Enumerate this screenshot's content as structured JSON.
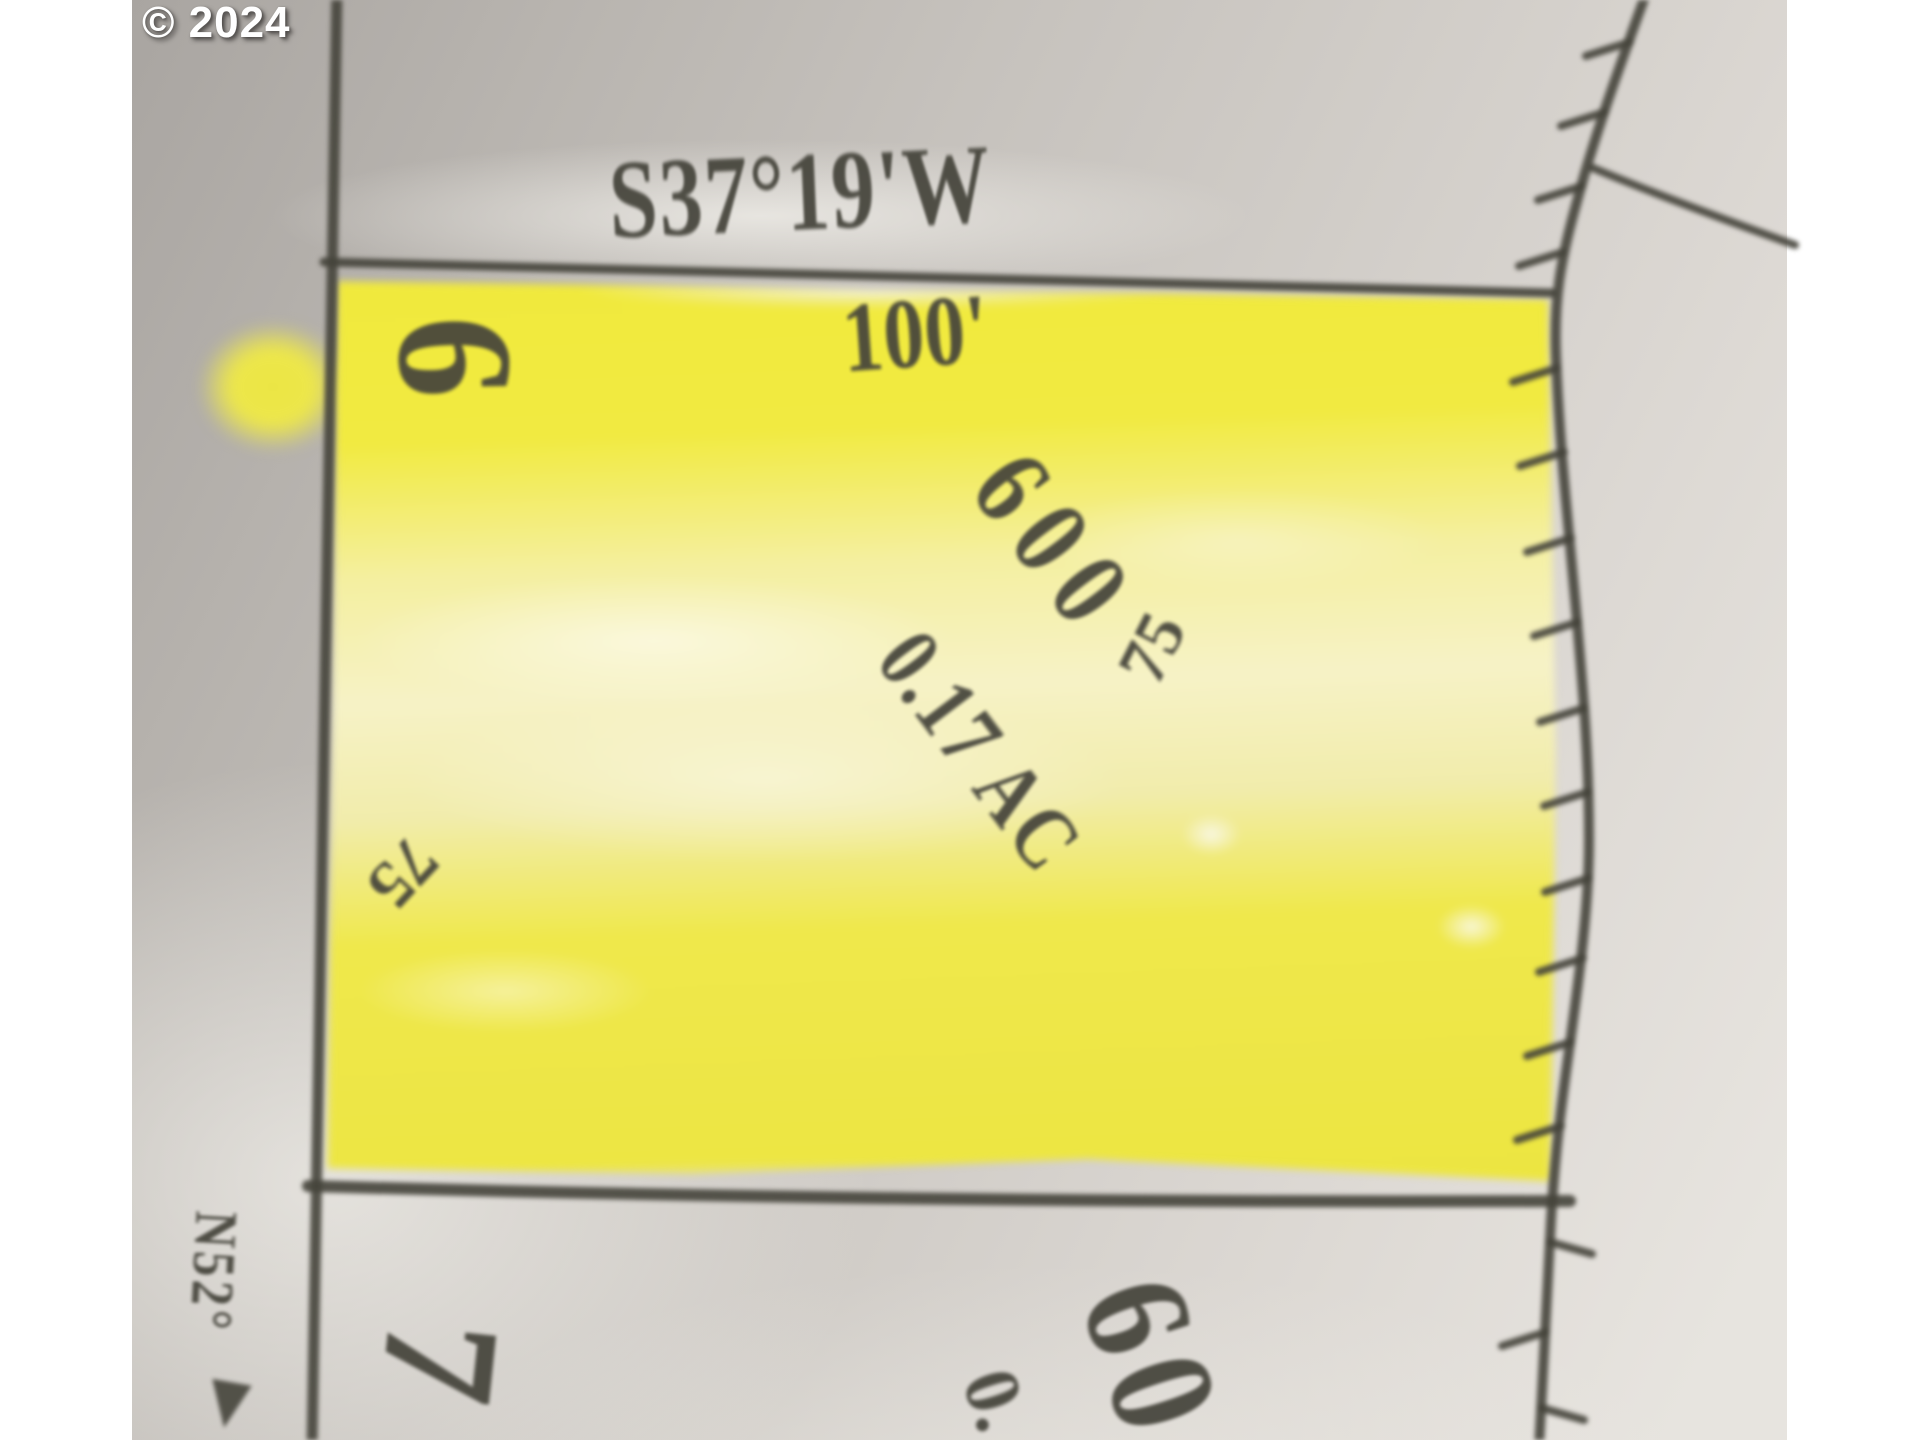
{
  "watermark": {
    "text": "© 2024"
  },
  "colors": {
    "highlight": "#f1ea41",
    "pencil": "#45443b",
    "paper_dark": "#a9a5a1",
    "paper_light": "#e7e4df",
    "watermark_text": "#ffffff"
  },
  "map": {
    "bearing_top": "S37°19'W",
    "top_dimension": "100'",
    "lot_number": "6",
    "parcel_number": "600",
    "parcel_area": "0.17 AC",
    "left_dimension": "75",
    "right_dimension": "75",
    "adjacent_lot_number": "7",
    "adjacent_parcel_number": "60",
    "adjacent_parcel_partial": "0.",
    "left_bearing": "N52°"
  }
}
